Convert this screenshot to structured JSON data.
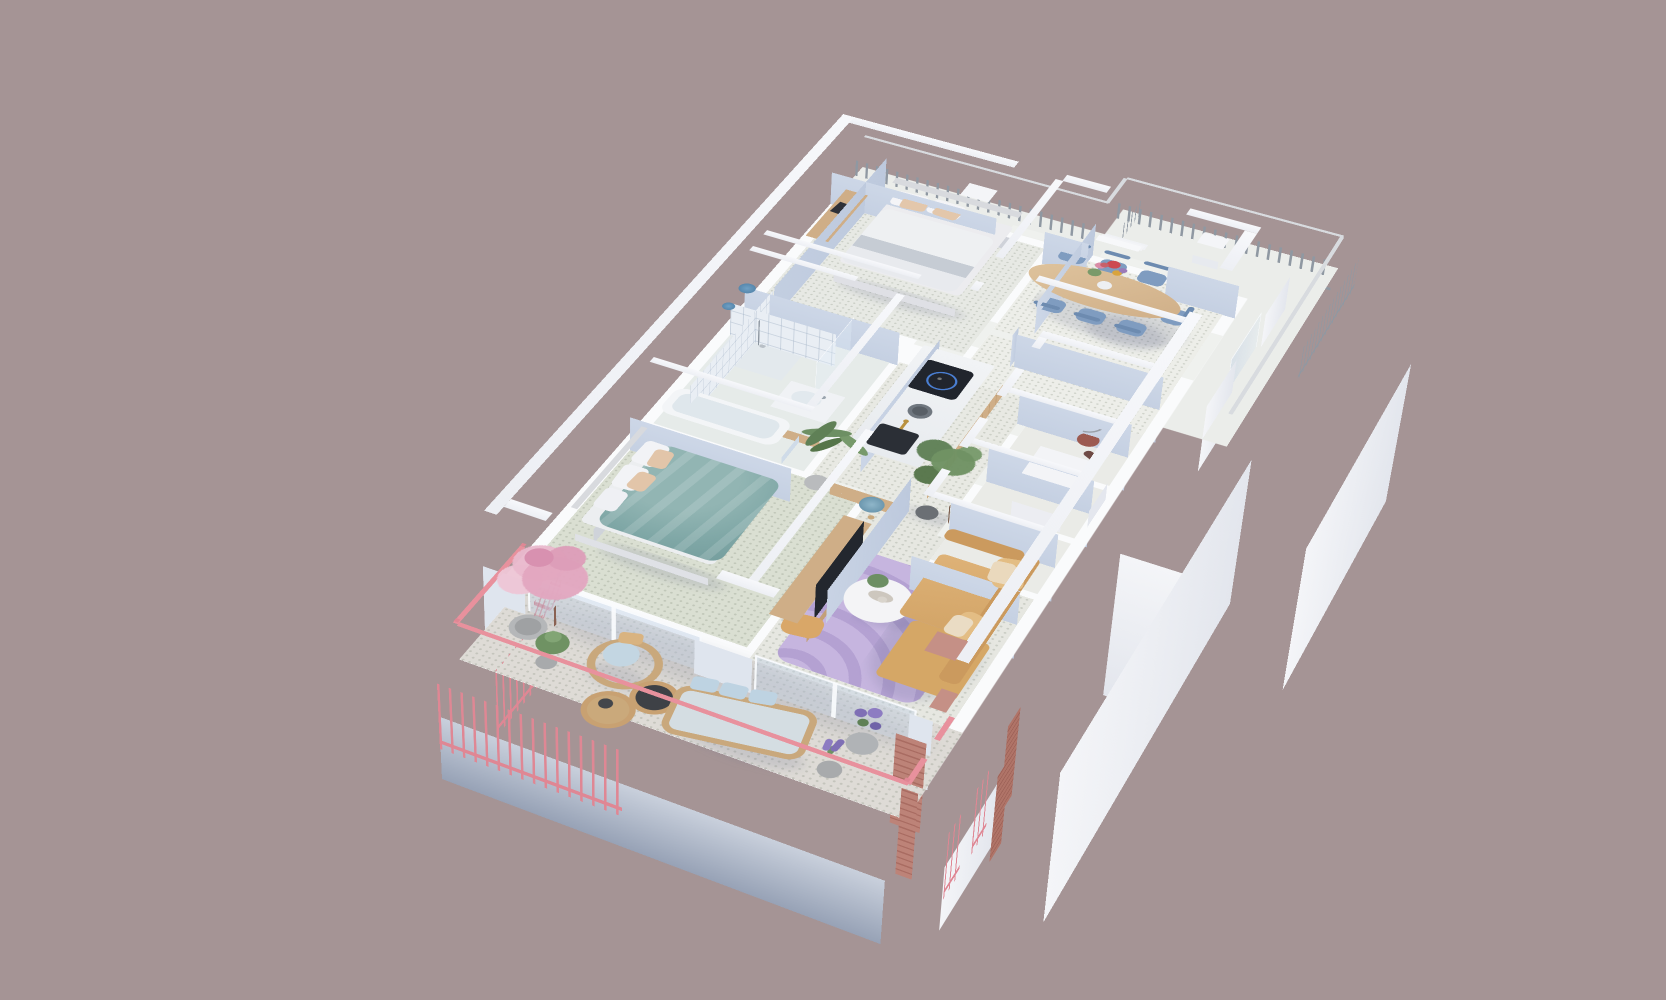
{
  "scene": {
    "title": "3D isometric floor plan render of a two-bedroom apartment with terrace and wrap-around balcony",
    "background_color": "#a59495",
    "camera": "high-angle dollhouse view, building rotated diagonally",
    "rooms": [
      {
        "name": "Master Bedroom",
        "position": "top left",
        "items": [
          "double bed with white duvet and gray throw band",
          "two white pillows",
          "two beige pillows",
          "upholstered light-gray headboard",
          "wooden desk with dark metal frame",
          "laptop",
          "orange stool"
        ]
      },
      {
        "name": "Dining Room",
        "position": "top right",
        "items": [
          "oval light-wood dining table",
          "seven muted-blue chairs",
          "bouquet with red, pink, yellow and purple flowers in white vase",
          "opening to upper balcony"
        ]
      },
      {
        "name": "Bathroom",
        "position": "middle left",
        "items": [
          "light-blue wall tiles",
          "walk-in shower with two blue rainfall heads",
          "glass shower screen",
          "white bathtub",
          "vanity with white basin and chrome tap"
        ]
      },
      {
        "name": "Kitchen",
        "position": "center",
        "items": [
          "light-wood cabinet run",
          "white stone worktop",
          "black induction hob with blue ring",
          "dark undermount sink with brass tap",
          "gray bowl"
        ]
      },
      {
        "name": "Hallway",
        "position": "center",
        "items": [
          "large potted ficus tree"
        ]
      },
      {
        "name": "Storage and Utility Rooms",
        "position": "center right",
        "items": [
          "vacuum cleaner with hose",
          "white storage cabinet",
          "three small rooms off the corridor"
        ]
      },
      {
        "name": "Second Bedroom",
        "position": "bottom left",
        "items": [
          "double bed with teal duvet",
          "white and beige pillows",
          "light headboard",
          "potted palm",
          "glass slider to terrace"
        ]
      },
      {
        "name": "Living Room",
        "position": "bottom right",
        "items": [
          "camel L-shaped sofa with tan back cushions",
          "lavender rug with wavy pattern",
          "round white coffee table with fern and cups",
          "camel ottoman",
          "wood media console with white drawer fronts",
          "flat TV facing second bedroom",
          "blue mushroom glass table lamp"
        ]
      },
      {
        "name": "Terrace",
        "position": "bottom, wrapping the lower facade",
        "items": [
          "pink metal balustrade",
          "cherry-blossom tree on pink trellis with round planter",
          "green shrub in pot",
          "rattan armchair with light-blue cushion and tan pillow",
          "two rattan drum side tables",
          "rattan two-seater sofa with three light-blue pillows",
          "planter with purple flowers",
          "lavender pot",
          "two pink brick pillars"
        ]
      },
      {
        "name": "Upper Balcony",
        "position": "top and right, wrapping the upper facade",
        "items": [
          "gray metal balustrade with light handrail",
          "three steps",
          "two white utility boxes"
        ]
      }
    ],
    "palette": {
      "background": "#a59495",
      "wall_top": "#f6f7fa",
      "wall_face_blue": "#c2cee2",
      "wall_face_white": "#eef0f5",
      "floor_speckle": "#e7e9e4",
      "floor_bedroom2": "#dadfd2",
      "terrace_floor": "#dedbd6",
      "pink_railing": "#df8794",
      "gray_railing": "#8f98a2",
      "teal_duvet": "#7fa7a6",
      "camel_sofa": "#d5a766",
      "lavender_rug": "#c6b5df",
      "wood": "#cfae87",
      "chair_blue": "#7f9cc0",
      "plant_green": "#6f9263",
      "blossom_pink": "#e2a6bf",
      "brick": "#b07468",
      "cushion_blue": "#bed3e2",
      "cooktop_black": "#21252d",
      "accent_flower_red": "#cc4a52"
    }
  }
}
